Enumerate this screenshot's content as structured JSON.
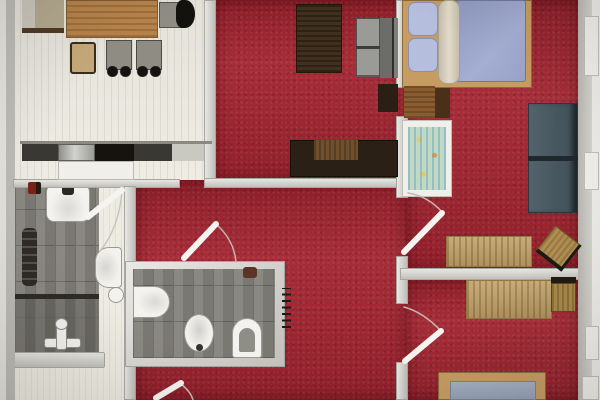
{
  "document": {
    "type": "floor-plan-photo",
    "description": "Top-down rendered floor plan of an apartment: kitchen-dining room with tiled floor, red carpeted living room and two bedrooms, two gray tiled bathrooms, hallway"
  },
  "palette": {
    "base-floor": "#e7e5de",
    "floor-white": "#edebe2",
    "page-white": "#efeeea",
    "carpet-red": "#a32531",
    "wall-gray": "#d2d1cb",
    "wall-edge": "#a7a6a0",
    "tile-gray": "#83817a",
    "tile-dark": "#6f6d66",
    "grout": "#67665d",
    "fixture-white": "#f3f2ee",
    "wood-mid": "#b5824a",
    "wood-dark": "#42301e",
    "steel": "#b4b4b0",
    "cooktop-black": "#16130f",
    "counter-dark": "#3a3832",
    "sofa-gray": "#9a9a96",
    "sofa-back": "#6c6c68",
    "slate-sofa": "#46565f",
    "mattress-blue": "#96a0c6",
    "pillow-blue": "#b6bedd",
    "blanket-beige": "#d8d1c0",
    "bed-frame-tan": "#c69c63",
    "crib-green": "#bfd9c4",
    "radiator-white": "#f2f1ed"
  },
  "rooms": [
    {
      "id": "dining-kitchen",
      "label": "Kitchen / dining room"
    },
    {
      "id": "living-room",
      "label": "Living room"
    },
    {
      "id": "bathroom-shower",
      "label": "Bathroom with tub and shower"
    },
    {
      "id": "bathroom-wc",
      "label": "WC with bidet"
    },
    {
      "id": "bedroom-main",
      "label": "Bedroom with double bed and crib"
    },
    {
      "id": "bedroom-second",
      "label": "Bedroom with single bed"
    },
    {
      "id": "hallway",
      "label": "Hallway"
    }
  ],
  "furniture": {
    "dining_kitchen": [
      "sideboard",
      "dining table",
      "four chairs",
      "kitchen counter with sink and cooktop"
    ],
    "living_room": [
      "dark wood board",
      "gray sofa",
      "dark side table",
      "tv lowboard"
    ],
    "bathroom_shower": [
      "washbasin",
      "towel radiator",
      "toilet",
      "bathtub with mixer tap"
    ],
    "bathroom_wc": [
      "wall basin",
      "bidet",
      "toilet",
      "scale",
      "towel radiator"
    ],
    "bedroom_main": [
      "double bed",
      "pillows",
      "blanket roll",
      "dresser",
      "baby crib",
      "slate daybed",
      "desk",
      "swivel chair"
    ],
    "bedroom_second": [
      "desk",
      "stool",
      "single bed"
    ],
    "fixtures": [
      "wall radiators",
      "interior doors with swing arcs",
      "entrance door"
    ]
  }
}
